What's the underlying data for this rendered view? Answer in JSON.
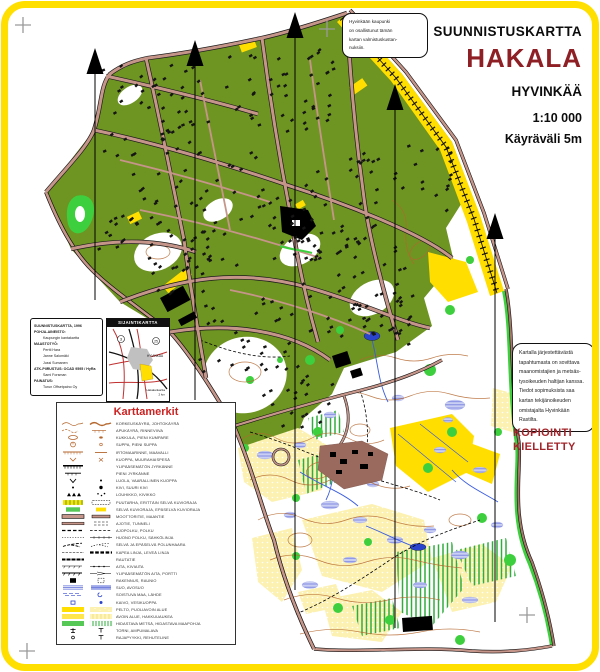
{
  "theme": {
    "frame_yellow": "#FFDF00",
    "dark_red": "#8E1F24",
    "notice_red": "#A3242A",
    "legend_red": "#CC2222",
    "map_olive": "#6E9422",
    "map_open_yellow": "#FFDE00",
    "map_road": "#C6958A",
    "map_contour_brown": "#B5672E",
    "map_marsh_blue": "#7B84E0",
    "map_park_green": "#3ECF3E"
  },
  "title_block": {
    "kind": "SUUNNISTUSKARTTA",
    "name": "HAKALA",
    "city": "HYVINKÄÄ",
    "scale": "1:10 000",
    "contour_interval": "Käyräväli 5m"
  },
  "top_note": {
    "lines": [
      "Hyvinkään kaupunki",
      "on osallistunut tämän",
      "kartan valmistuskustan-",
      "nuksiin."
    ]
  },
  "credits": {
    "rows": [
      {
        "text": "SUUNNISTUSKARTTA, 1996",
        "style": "head"
      },
      {
        "text": "POHJA-AINEISTO:",
        "style": "head"
      },
      {
        "text": "Kaupungin kantakartta",
        "style": "ind"
      },
      {
        "text": "MAASTOTYÖ:",
        "style": "head"
      },
      {
        "text": "Pertti Hara",
        "style": "ind"
      },
      {
        "text": "Janne Salomäki",
        "style": "ind"
      },
      {
        "text": "Jussi Sumanen",
        "style": "ind"
      },
      {
        "text": "ATK-PIIRUSTUS: OCAD 9595 / HyRa",
        "style": "head"
      },
      {
        "text": "Sami Forsman",
        "style": "ind"
      },
      {
        "text": "PAINATUS:",
        "style": "head"
      },
      {
        "text": "Turun Offsetpaino Oy",
        "style": "ind"
      }
    ]
  },
  "locator": {
    "header": "SIJAINTIKARTTA",
    "city": "HYVINKÄÄ",
    "road_numbers": [
      "3",
      "25"
    ],
    "caption": [
      "Hakalankartta",
      "2 km"
    ]
  },
  "legend": {
    "title": "Karttamerkit",
    "rows": [
      {
        "label": "KORKEUSKÄYRÄ, JOHTOKÄYRÄ",
        "sym": "contour"
      },
      {
        "label": "APUKÄYRÄ, RINNEVIIVA",
        "sym": "aux"
      },
      {
        "label": "KUKKULA, PIENI KUMPARE",
        "sym": "knoll"
      },
      {
        "label": "SUPPA, PIENI SUPPA",
        "sym": "suppa"
      },
      {
        "label": "IRTOMAARINNE, MAAVALLI",
        "sym": "earthbank"
      },
      {
        "label": "KUOPPA, MUURAHAISPESÄ",
        "sym": "pit"
      },
      {
        "label": "YLIPÄÄSEMÄTÖN JYRKÄNNE",
        "sym": "impassablecliff"
      },
      {
        "label": "PIENI JYRKÄNNE",
        "sym": "smallcliff"
      },
      {
        "label": "LUOLA, VAARALLINEN KUOPPA",
        "sym": "cave"
      },
      {
        "label": "KIVI, SUURI KIVI",
        "sym": "stone"
      },
      {
        "label": "LOUHIKKO, KIVIKKO",
        "sym": "boulder"
      },
      {
        "label": "PUUTARHA, ERITTÄIN SELVÄ KUVIORAJA",
        "sym": "garden"
      },
      {
        "label": "SELVÄ KUVIORAJA, EPÄSELVÄ KUVIORAJA",
        "sym": "vegb"
      },
      {
        "label": "MOOTTORITIE, MAANTIE",
        "sym": "motorway"
      },
      {
        "label": "AJOTIE, TUNNELI",
        "sym": "roadtunnel"
      },
      {
        "label": "AJOPOLKU, POLKU",
        "sym": "track"
      },
      {
        "label": "HUONO POLKU, SÄHKÖLINJA",
        "sym": "pathpower"
      },
      {
        "label": "SELVÄ JA EPÄSELVÄ POLUNHAARA",
        "sym": "junction"
      },
      {
        "label": "KAPEA LINJA, LEVEÄ LINJA",
        "sym": "ride"
      },
      {
        "label": "RAUTATIE",
        "sym": "railway"
      },
      {
        "label": "AITA, KIVIAITA",
        "sym": "fence"
      },
      {
        "label": "YLIPÄÄSEMÄTÖN AITA, PORTTI",
        "sym": "fencegate"
      },
      {
        "label": "RAKENNUS, RAUNIO",
        "sym": "building"
      },
      {
        "label": "SUO, AVOSUO",
        "sym": "marsh"
      },
      {
        "label": "SOISTUVA MAA, LÄHDE",
        "sym": "indistinct"
      },
      {
        "label": "KAIVO, VESIKUOPPA",
        "sym": "well"
      },
      {
        "label": "PELTO, PUOLIAVOIN ALUE",
        "sym": "field"
      },
      {
        "label": "AVOIN ALUE, HAKKUUAUKEA",
        "sym": "open"
      },
      {
        "label": "HIDASTAVA METSÄ, HIDASTAVA MAAPOHJA",
        "sym": "slowforest"
      },
      {
        "label": "TORNI, AMPUMALAVA",
        "sym": "tower"
      },
      {
        "label": "RAJAPYYKKI, REHUTELINE",
        "sym": "cairn"
      }
    ]
  },
  "rights_note": {
    "lines": [
      "Kartalla järjestettävästä",
      "tapahtumasta on sovittava",
      "maanomistajien ja metsäs-",
      "tysoikeuden haltijan kanssa.",
      "Tiedot sopimuksista saa",
      "kartan tekijänoikeuden",
      "omistajalta Hyvinkään",
      "Rastilta."
    ]
  },
  "copy_notice": {
    "lines": [
      "KOPIOINTI",
      "KIELLETTY"
    ]
  },
  "map": {
    "north_lines": [
      {
        "x": 95,
        "tip": 48,
        "end": 300
      },
      {
        "x": 195,
        "tip": 40,
        "end": 400
      },
      {
        "x": 295,
        "tip": 12,
        "end": 590
      },
      {
        "x": 395,
        "tip": 84,
        "end": 628
      },
      {
        "x": 495,
        "tip": 213,
        "end": 622
      }
    ],
    "registration_crosses": [
      [
        23,
        25
      ],
      [
        327,
        29
      ],
      [
        27,
        651
      ],
      [
        527,
        615
      ]
    ]
  }
}
